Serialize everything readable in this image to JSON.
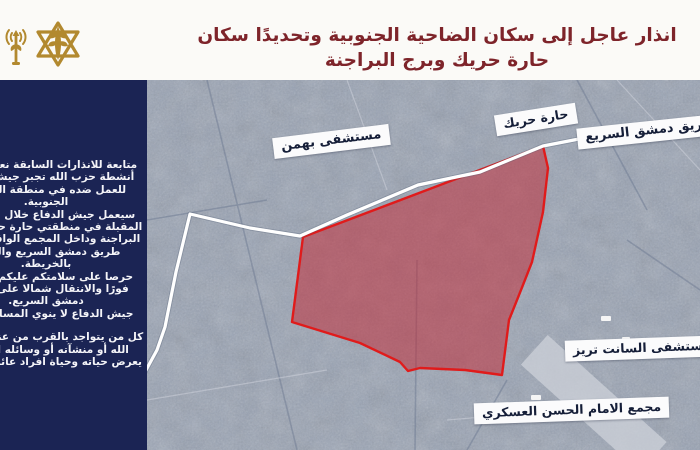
{
  "header": {
    "title": "انذار عاجل إلى سكان الضاحية الجنوبية وتحديدًا سكان حارة حريك وبرج البراجنة",
    "title_color": "#7e242a",
    "icons": {
      "left_icon": "broadcast-antenna-icon",
      "emblem_icon": "idf-insignia-icon",
      "icon_color": "#b2892f"
    }
  },
  "sidebar": {
    "background_color": "#1b2454",
    "text_color": "#f4f4f8",
    "lines": [
      "متابعة للانذارات السابقة نعود ونؤكد",
      "أنشطة حزب الله تجبر جيش الدفاع",
      "للعمل ضده في منطقة الضاحية",
      "الجنوبية.",
      "سيعمل جيش الدفاع خلال الساعات",
      "المقبلة في منطقتي حارة حريك وبرج",
      "البراجنة وداخل المجمع الواقع جنوبي",
      "طريق دمشق السريع والمحدد",
      "بالخريطة.",
      "حرصا على سلامتكم عليكم الخروج",
      "فورًا والانتقال شمالا على طريق",
      "دمشق السريع.",
      "جيش الدفاع لا ينوي المساس بكم."
    ],
    "lines_after_gap": [
      "كل من يتواجد بالقرب من عناصر حزب",
      "الله أو منشآته أو وسائله القتالية",
      "يعرض حياته وحياة افراد عائلته للخطر"
    ]
  },
  "map": {
    "base_color": "#98a2b3",
    "labels": [
      {
        "id": "haret-hreik",
        "text": "حارة حريك"
      },
      {
        "id": "damascus-expressway",
        "text": "طريق دمشق السريع"
      },
      {
        "id": "bahman-hospital",
        "text": "مستشفى بهمن"
      },
      {
        "id": "saint-therese-hospital",
        "text": "مستشفى السانت تريز"
      },
      {
        "id": "imam-hassan-complex",
        "text": "مجمع الامام الحسن العسكري"
      }
    ],
    "zone": {
      "description": "red warning evacuation zone polygon",
      "fill": "#c42330",
      "fill_opacity": "0.5",
      "border_color": "#e01b1b",
      "points": "156,157 396,66 401,88 396,132 385,182 374,210 362,240 355,295 318,290 273,288 261,291 253,282 213,263 145,242"
    },
    "road": {
      "description": "white highlighted road (Damascus expressway)",
      "color": "#ffffff",
      "points": "553,38 473,51 396,66 333,92 271,105 200,135 153,156 103,148 43,134 29,192 18,247 10,270 -2,292"
    }
  }
}
